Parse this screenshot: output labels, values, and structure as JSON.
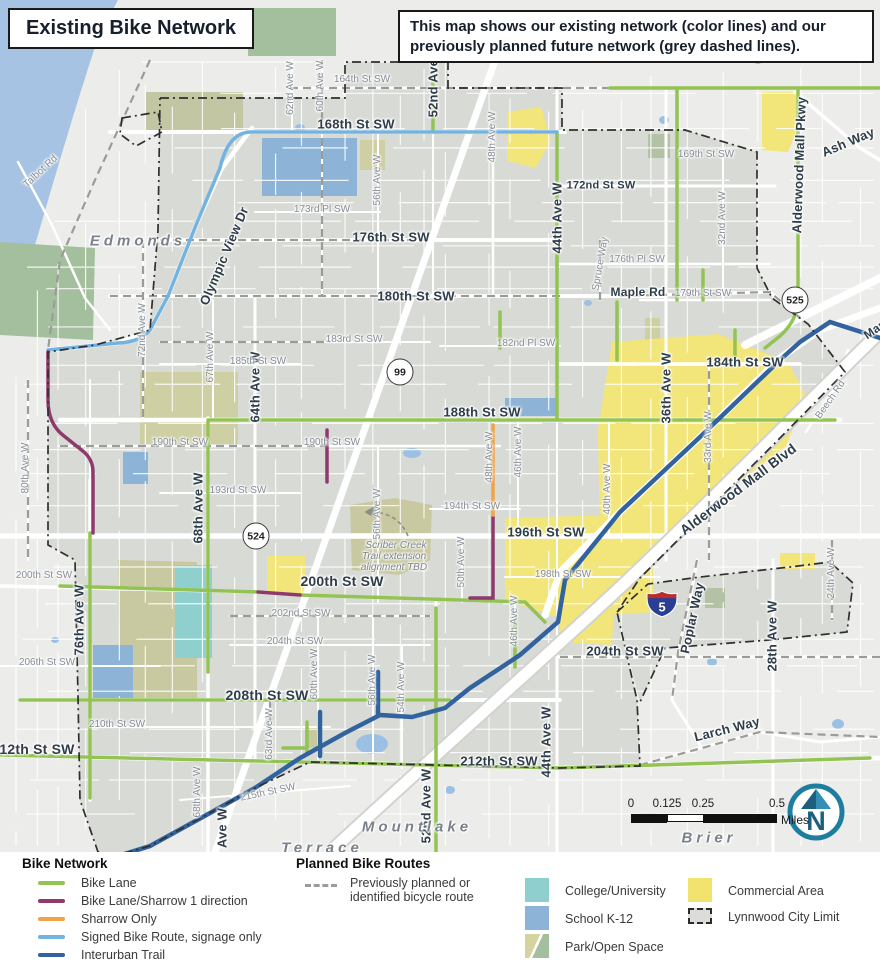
{
  "header": {
    "title": "Existing Bike Network",
    "info": "This map shows our existing network (color lines) and our previously planned future network (grey dashed lines)."
  },
  "map": {
    "labels": [
      {
        "t": "168th St SW",
        "x": 356,
        "y": 124,
        "k": "st"
      },
      {
        "t": "176th St SW",
        "x": 391,
        "y": 237,
        "k": "st"
      },
      {
        "t": "180th St SW",
        "x": 416,
        "y": 296,
        "k": "st"
      },
      {
        "t": "184th St SW",
        "x": 745,
        "y": 362,
        "k": "st"
      },
      {
        "t": "188th St SW",
        "x": 482,
        "y": 412,
        "k": "st"
      },
      {
        "t": "196th St SW",
        "x": 546,
        "y": 532,
        "k": "st"
      },
      {
        "t": "200th St SW",
        "x": 342,
        "y": 581,
        "k": "st",
        "s": 14
      },
      {
        "t": "208th St SW",
        "x": 267,
        "y": 695,
        "k": "st",
        "s": 14
      },
      {
        "t": "212th St SW",
        "x": 33,
        "y": 749,
        "k": "st",
        "s": 14
      },
      {
        "t": "212th St SW",
        "x": 499,
        "y": 761,
        "k": "st"
      },
      {
        "t": "204th St SW",
        "x": 625,
        "y": 651,
        "k": "st"
      },
      {
        "t": "172nd St SW",
        "x": 601,
        "y": 186,
        "k": "st",
        "s": 11
      },
      {
        "t": "Maple Rd",
        "x": 638,
        "y": 292,
        "k": "st",
        "s": 12
      },
      {
        "t": "Larch Way",
        "x": 727,
        "y": 729,
        "k": "st",
        "r": -14
      },
      {
        "t": "Ash Way",
        "x": 848,
        "y": 142,
        "k": "st",
        "r": -23
      },
      {
        "t": "Poplar Way",
        "x": 692,
        "y": 618,
        "k": "st",
        "r": -78
      },
      {
        "t": "Olympic View Dr",
        "x": 224,
        "y": 256,
        "k": "st",
        "r": -67
      },
      {
        "t": "Alderwood Mall Pkwy",
        "x": 799,
        "y": 165,
        "k": "st",
        "r": -88
      },
      {
        "t": "Alderwood Mall Blvd",
        "x": 738,
        "y": 489,
        "k": "st",
        "r": -37,
        "s": 14
      },
      {
        "t": "52nd Ave W",
        "x": 433,
        "y": 80,
        "k": "st",
        "r": -90
      },
      {
        "t": "44th Ave W",
        "x": 557,
        "y": 218,
        "k": "st",
        "r": -90
      },
      {
        "t": "64th Ave W",
        "x": 255,
        "y": 387,
        "k": "st",
        "r": -90
      },
      {
        "t": "68th Ave W",
        "x": 198,
        "y": 508,
        "k": "st",
        "r": -90
      },
      {
        "t": "36th Ave W",
        "x": 666,
        "y": 388,
        "k": "st",
        "r": -90
      },
      {
        "t": "76th Ave W",
        "x": 79,
        "y": 620,
        "k": "st",
        "r": -90
      },
      {
        "t": "52nd Ave W",
        "x": 426,
        "y": 806,
        "k": "st",
        "r": -90
      },
      {
        "t": "44th Ave W",
        "x": 546,
        "y": 742,
        "k": "st",
        "r": -90
      },
      {
        "t": "28th Ave W",
        "x": 772,
        "y": 636,
        "k": "st",
        "r": -90
      },
      {
        "t": "Ave W",
        "x": 222,
        "y": 828,
        "k": "st",
        "r": -90
      },
      {
        "t": "Mar",
        "x": 874,
        "y": 330,
        "k": "st",
        "r": -35,
        "s": 12
      },
      {
        "t": "164th St SW",
        "x": 362,
        "y": 80,
        "k": "mi"
      },
      {
        "t": "169th St SW",
        "x": 706,
        "y": 155,
        "k": "mi"
      },
      {
        "t": "173rd Pl SW",
        "x": 322,
        "y": 210,
        "k": "mi"
      },
      {
        "t": "176th Pl SW",
        "x": 637,
        "y": 260,
        "k": "mi"
      },
      {
        "t": "179th St SW",
        "x": 703,
        "y": 294,
        "k": "mi"
      },
      {
        "t": "183rd St SW",
        "x": 354,
        "y": 340,
        "k": "mi"
      },
      {
        "t": "185th St SW",
        "x": 258,
        "y": 362,
        "k": "mi"
      },
      {
        "t": "182nd Pl SW",
        "x": 526,
        "y": 344,
        "k": "mi"
      },
      {
        "t": "190th St SW",
        "x": 180,
        "y": 443,
        "k": "mi"
      },
      {
        "t": "190th St SW",
        "x": 332,
        "y": 443,
        "k": "mi"
      },
      {
        "t": "193rd St SW",
        "x": 238,
        "y": 491,
        "k": "mi"
      },
      {
        "t": "194th St SW",
        "x": 472,
        "y": 507,
        "k": "mi"
      },
      {
        "t": "198th St SW",
        "x": 563,
        "y": 575,
        "k": "mi"
      },
      {
        "t": "200th St SW",
        "x": 44,
        "y": 576,
        "k": "mi"
      },
      {
        "t": "202nd St SW",
        "x": 301,
        "y": 614,
        "k": "mi"
      },
      {
        "t": "204th St SW",
        "x": 295,
        "y": 642,
        "k": "mi"
      },
      {
        "t": "206th St SW",
        "x": 47,
        "y": 663,
        "k": "mi"
      },
      {
        "t": "210th St SW",
        "x": 117,
        "y": 725,
        "k": "mi"
      },
      {
        "t": "215th St SW",
        "x": 268,
        "y": 793,
        "k": "mi",
        "r": -12
      },
      {
        "t": "Talbot Rd",
        "x": 41,
        "y": 172,
        "k": "mi",
        "r": -43
      },
      {
        "t": "Spruce Way",
        "x": 601,
        "y": 264,
        "k": "mi",
        "r": -80
      },
      {
        "t": "Beech Rd",
        "x": 831,
        "y": 400,
        "k": "mi",
        "r": -55
      },
      {
        "t": "62nd Ave W",
        "x": 291,
        "y": 88,
        "k": "mi",
        "r": -90
      },
      {
        "t": "60th Ave W",
        "x": 321,
        "y": 86,
        "k": "mi",
        "r": -90
      },
      {
        "t": "56th Ave W",
        "x": 378,
        "y": 180,
        "k": "mi",
        "r": -90
      },
      {
        "t": "48th Ave W",
        "x": 493,
        "y": 137,
        "k": "mi",
        "r": -90
      },
      {
        "t": "72nd Ave W",
        "x": 143,
        "y": 330,
        "k": "mi",
        "r": -90
      },
      {
        "t": "67th Ave W",
        "x": 211,
        "y": 357,
        "k": "mi",
        "r": -90
      },
      {
        "t": "80th Ave W",
        "x": 26,
        "y": 468,
        "k": "mi",
        "r": -90
      },
      {
        "t": "56th Ave W",
        "x": 378,
        "y": 514,
        "k": "mi",
        "r": -90
      },
      {
        "t": "50th Ave W",
        "x": 462,
        "y": 562,
        "k": "mi",
        "r": -90
      },
      {
        "t": "48th Ave W",
        "x": 490,
        "y": 457,
        "k": "mi",
        "r": -90
      },
      {
        "t": "46th Ave W",
        "x": 519,
        "y": 452,
        "k": "mi",
        "r": -90
      },
      {
        "t": "40th Ave W",
        "x": 608,
        "y": 489,
        "k": "mi",
        "r": -90
      },
      {
        "t": "33rd Ave W",
        "x": 709,
        "y": 437,
        "k": "mi",
        "r": -90
      },
      {
        "t": "32nd Ave W",
        "x": 723,
        "y": 218,
        "k": "mi",
        "r": -90
      },
      {
        "t": "46th Ave W",
        "x": 515,
        "y": 621,
        "k": "mi",
        "r": -90
      },
      {
        "t": "63rd Ave W",
        "x": 270,
        "y": 734,
        "k": "mi",
        "r": -90
      },
      {
        "t": "60th Ave W",
        "x": 315,
        "y": 674,
        "k": "mi",
        "r": -90
      },
      {
        "t": "56th Ave W",
        "x": 373,
        "y": 680,
        "k": "mi",
        "r": -90
      },
      {
        "t": "54th Ave W",
        "x": 402,
        "y": 687,
        "k": "mi",
        "r": -90
      },
      {
        "t": "24th Ave W",
        "x": 832,
        "y": 573,
        "k": "mi",
        "r": -90
      },
      {
        "t": "68th Ave W",
        "x": 198,
        "y": 792,
        "k": "mi",
        "r": -90
      },
      {
        "t": "Edmonds",
        "x": 138,
        "y": 241,
        "k": "ci"
      },
      {
        "t": "Mountlake",
        "x": 417,
        "y": 827,
        "k": "ci"
      },
      {
        "t": "Terrace",
        "x": 322,
        "y": 848,
        "k": "ci"
      },
      {
        "t": "Brier",
        "x": 709,
        "y": 838,
        "k": "ci"
      },
      {
        "t": "Scriber Creek",
        "x": 396,
        "y": 546,
        "k": "an"
      },
      {
        "t": "Trail extension",
        "x": 394,
        "y": 557,
        "k": "an"
      },
      {
        "t": "alignment TBD",
        "x": 394,
        "y": 568,
        "k": "an"
      }
    ],
    "shields": [
      {
        "label": "99",
        "x": 400,
        "y": 372,
        "type": "circle"
      },
      {
        "label": "524",
        "x": 256,
        "y": 536,
        "type": "circle"
      },
      {
        "label": "525",
        "x": 795,
        "y": 300,
        "type": "circle"
      },
      {
        "label": "5",
        "x": 646,
        "y": 590,
        "type": "interstate"
      }
    ],
    "scale_bar": {
      "ticks": [
        "0",
        "0.125",
        "0.25",
        "0.5"
      ],
      "unit": "Miles"
    },
    "north_arrow_letter": "N"
  },
  "colors": {
    "bike_lane": "#93c353",
    "sharrow_1dir": "#8e3a6d",
    "sharrow_only": "#f0a348",
    "signed_route": "#72b3e0",
    "interurban": "#33639f",
    "planned": "#9b9b97",
    "water": "#a6c3e4",
    "city_fill": "#d8dad5",
    "commercial": "#f2e579",
    "college": "#8fd0cf",
    "school": "#8db4d6",
    "park_khaki": "#d5d3a0",
    "park_green": "#a4bf9d"
  },
  "legend": {
    "bike_network": {
      "heading": "Bike Network",
      "items": [
        {
          "label": "Bike Lane",
          "color": "#93c353"
        },
        {
          "label": "Bike Lane/Sharrow 1 direction",
          "color": "#8e3a6d"
        },
        {
          "label": "Sharrow Only",
          "color": "#f0a348"
        },
        {
          "label": "Signed Bike Route, signage only",
          "color": "#72b3e0"
        },
        {
          "label": "Interurban Trail",
          "color": "#33639f"
        }
      ]
    },
    "planned": {
      "heading": "Planned Bike Routes",
      "lines": [
        "Previously planned or",
        "identified bicycle route"
      ]
    },
    "land_use": {
      "college": {
        "label": "College/University",
        "color": "#8fd0cf"
      },
      "school": {
        "label": "School K-12",
        "color": "#8db4d6"
      },
      "park": {
        "label": "Park/Open Space"
      },
      "commercial": {
        "label": "Commercial Area",
        "color": "#f2e36f"
      },
      "city_limit": {
        "label": "Lynnwood City Limit",
        "color": "#dcddd8"
      }
    }
  }
}
